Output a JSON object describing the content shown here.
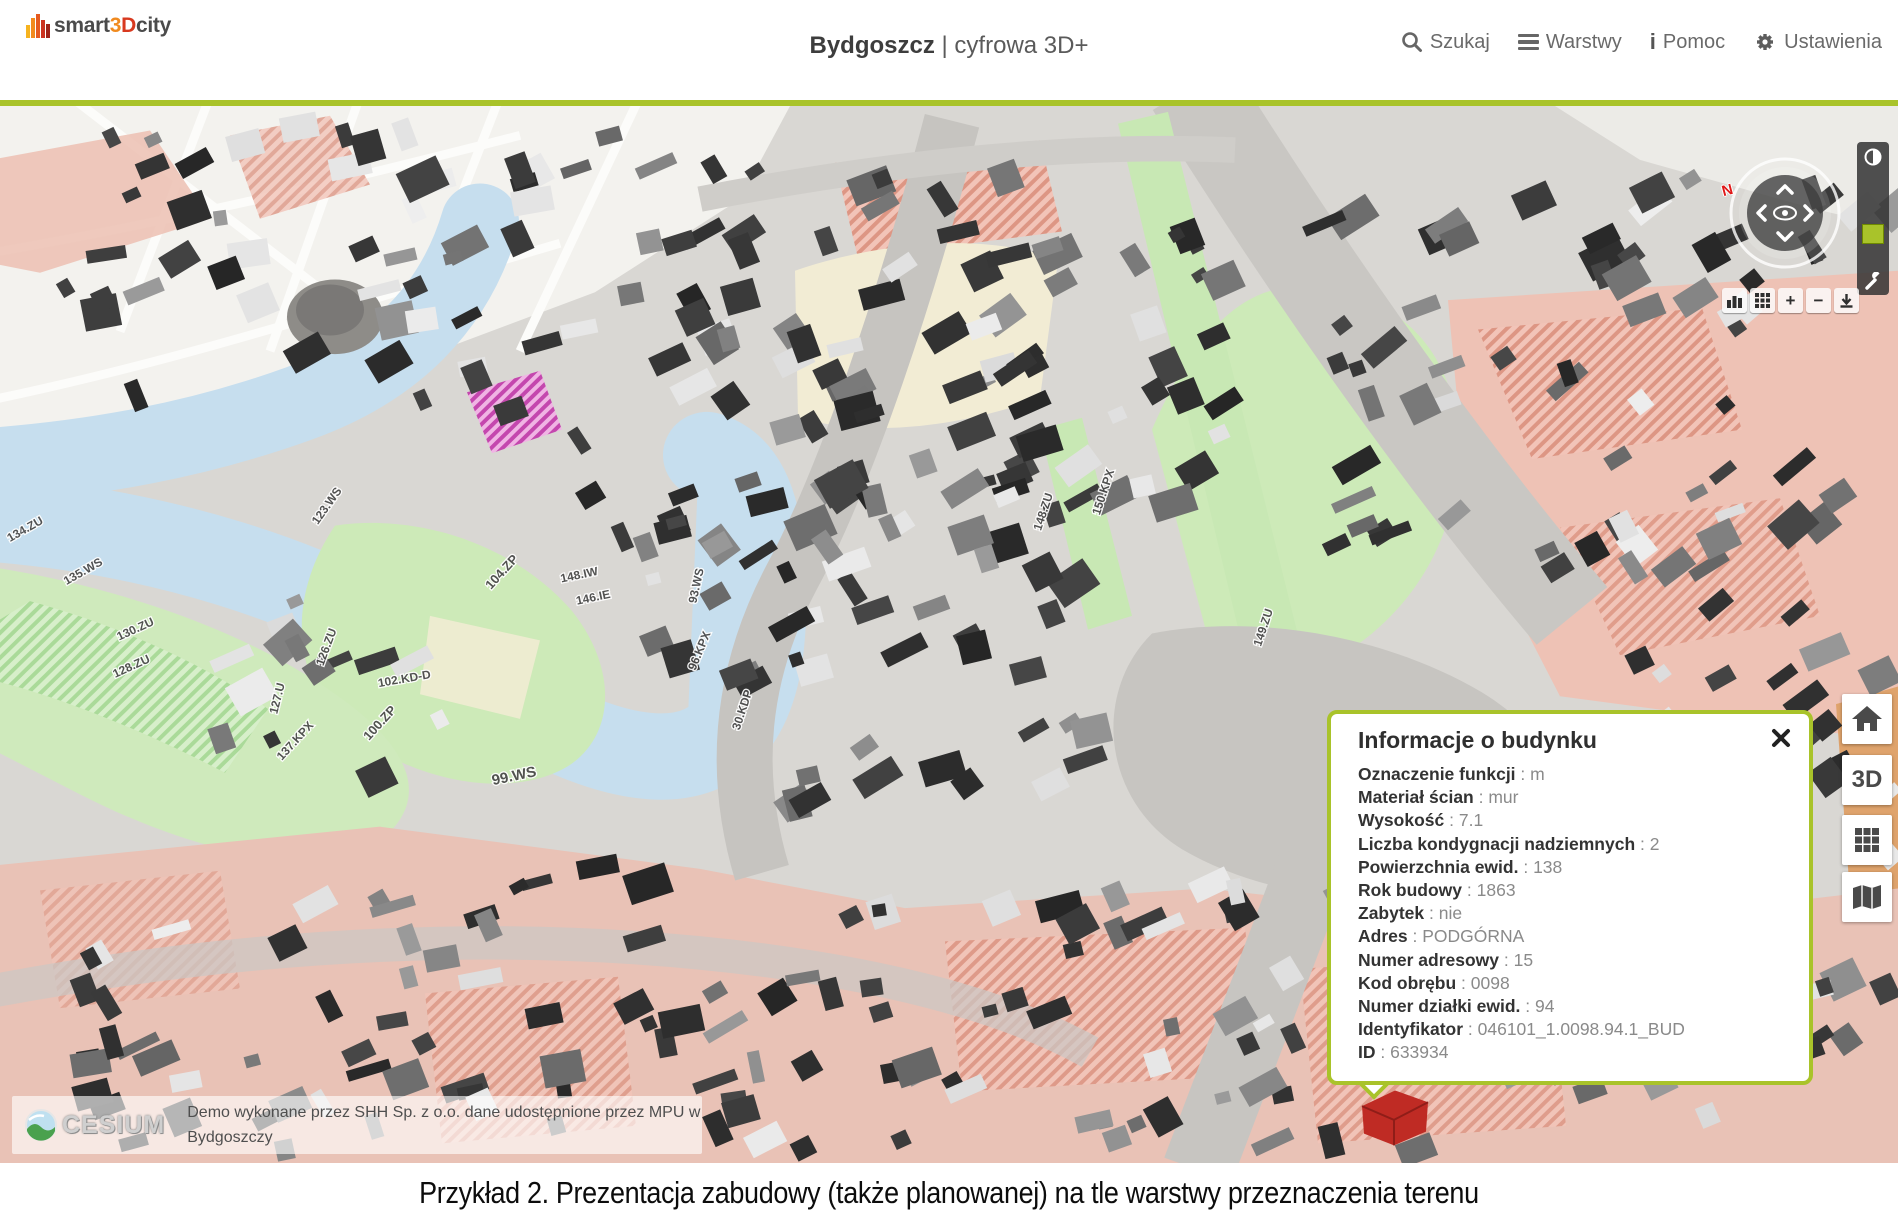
{
  "header": {
    "logo": {
      "part_smart": "smart",
      "part_3": "3",
      "part_d": "D",
      "part_city": "city"
    },
    "title": {
      "city": "Bydgoszcz",
      "suffix": "| cyfrowa 3D+"
    },
    "nav": [
      {
        "label": "Szukaj",
        "icon": "search-icon"
      },
      {
        "label": "Warstwy",
        "icon": "layers-icon"
      },
      {
        "label": "Pomoc",
        "icon": "info-icon",
        "glyph": "i"
      },
      {
        "label": "Ustawienia",
        "icon": "gear-icon"
      }
    ]
  },
  "compass": {
    "north": "N"
  },
  "map_toolbar": [
    {
      "icon": "buildings-icon"
    },
    {
      "icon": "grid-icon"
    },
    {
      "icon": "plus-icon",
      "label": "+"
    },
    {
      "icon": "minus-icon",
      "label": "−"
    },
    {
      "icon": "download-icon"
    }
  ],
  "side_toolbar": [
    {
      "name": "home",
      "icon": "home-icon"
    },
    {
      "name": "view-3d",
      "label": "3D"
    },
    {
      "name": "tiles",
      "icon": "grid-icon"
    },
    {
      "name": "map",
      "icon": "map-icon"
    }
  ],
  "popup": {
    "title": "Informacje o budynku",
    "separator": " : ",
    "fields": [
      {
        "label": "Oznaczenie funkcji",
        "value": "m"
      },
      {
        "label": "Materiał ścian",
        "value": "mur"
      },
      {
        "label": "Wysokość",
        "value": "7.1"
      },
      {
        "label": "Liczba kondygnacji nadziemnych",
        "value": "2"
      },
      {
        "label": "Powierzchnia ewid.",
        "value": "138"
      },
      {
        "label": "Rok budowy",
        "value": "1863"
      },
      {
        "label": "Zabytek",
        "value": "nie"
      },
      {
        "label": "Adres",
        "value": "PODGÓRNA"
      },
      {
        "label": "Numer adresowy",
        "value": "15"
      },
      {
        "label": "Kod obrębu",
        "value": "0098"
      },
      {
        "label": "Numer działki ewid.",
        "value": "94"
      },
      {
        "label": "Identyfikator",
        "value": "046101_1.0098.94.1_BUD"
      },
      {
        "label": "ID",
        "value": "633934"
      }
    ]
  },
  "attribution": {
    "brand": "CESIUM",
    "line1": "Demo wykonane przez SHH Sp. z o.o. dane udostępnione przez MPU w",
    "line2": "Bydgoszczy"
  },
  "caption": {
    "text": "Przykład 2. Prezentacja zabudowy (także planowanej) na tle warstwy przeznaczenia terenu"
  },
  "map": {
    "labels": [
      {
        "t": "123.WS",
        "x": 330,
        "y": 410,
        "r": -55
      },
      {
        "t": "99.WS",
        "x": 515,
        "y": 688,
        "r": -12,
        "s": 15
      },
      {
        "t": "100.ZP",
        "x": 383,
        "y": 632,
        "r": -48,
        "s": 13
      },
      {
        "t": "104.ZP",
        "x": 505,
        "y": 478,
        "r": -48,
        "s": 13
      },
      {
        "t": "102.KD-D",
        "x": 405,
        "y": 588,
        "r": -10
      },
      {
        "t": "137.KPX",
        "x": 298,
        "y": 650,
        "r": -48
      },
      {
        "t": "127.U",
        "x": 281,
        "y": 605,
        "r": -76
      },
      {
        "t": "126.ZU",
        "x": 330,
        "y": 553,
        "r": -70
      },
      {
        "t": "128.ZU",
        "x": 133,
        "y": 575,
        "r": -25
      },
      {
        "t": "130.ZU",
        "x": 137,
        "y": 537,
        "r": -25
      },
      {
        "t": "134.ZU",
        "x": 27,
        "y": 435,
        "r": -30
      },
      {
        "t": "135.WS",
        "x": 85,
        "y": 478,
        "r": -30
      },
      {
        "t": "146.IE",
        "x": 594,
        "y": 505,
        "r": -12
      },
      {
        "t": "148.IW",
        "x": 580,
        "y": 482,
        "r": -12
      },
      {
        "t": "93.WS",
        "x": 700,
        "y": 490,
        "r": -78
      },
      {
        "t": "96.KPX",
        "x": 703,
        "y": 557,
        "r": -68
      },
      {
        "t": "30.KDP",
        "x": 746,
        "y": 617,
        "r": -72
      },
      {
        "t": "148.ZU",
        "x": 1047,
        "y": 415,
        "r": -72
      },
      {
        "t": "150.KPX",
        "x": 1107,
        "y": 395,
        "r": -72
      },
      {
        "t": "149.ZU",
        "x": 1267,
        "y": 533,
        "r": -72
      }
    ]
  },
  "colors": {
    "accent_green": "#a9c32a",
    "selection_red": "#bf2b24",
    "water_blue": "#c6deee",
    "zone_green": "#cdeab8",
    "zone_salmon": "#eec2b5",
    "zone_beige": "#f2ecd4",
    "logo_orange": "#f08a1f",
    "logo_red": "#d8391f"
  }
}
